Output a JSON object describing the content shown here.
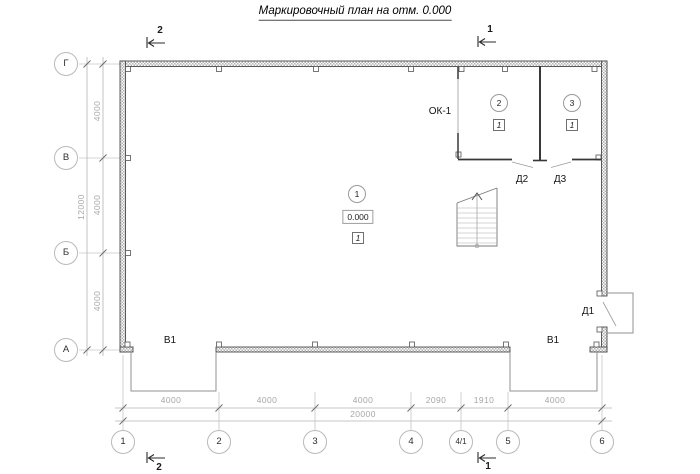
{
  "title": "Маркировочный план на отм. 0.000",
  "axes": {
    "rows": [
      "Г",
      "В",
      "Б",
      "А"
    ],
    "cols": [
      "1",
      "2",
      "3",
      "4",
      "4/1",
      "5",
      "6"
    ]
  },
  "dimensions": {
    "left_segments": [
      "4000",
      "4000",
      "4000"
    ],
    "left_total": "12000",
    "bottom_segments": [
      "4000",
      "4000",
      "4000",
      "2090",
      "1910",
      "4000"
    ],
    "bottom_total": "20000"
  },
  "rooms": [
    {
      "number": "1",
      "elevation": "0.000",
      "floor_type": "1"
    },
    {
      "number": "2",
      "floor_type": "1"
    },
    {
      "number": "3",
      "floor_type": "1"
    }
  ],
  "openings": {
    "window": "ОК-1",
    "door_d1": "Д1",
    "door_d2": "Д2",
    "door_d3": "Д3",
    "gate_left": "В1",
    "gate_right": "В1"
  },
  "section_marks": {
    "top_left": "2",
    "bottom_left": "2",
    "top_right": "1",
    "bottom_right": "1"
  },
  "colors": {
    "wall_edge": "#4a4a4a",
    "thin_line": "#b5b5b5",
    "dim_text": "#a6a6a6",
    "label_text": "#141414"
  }
}
